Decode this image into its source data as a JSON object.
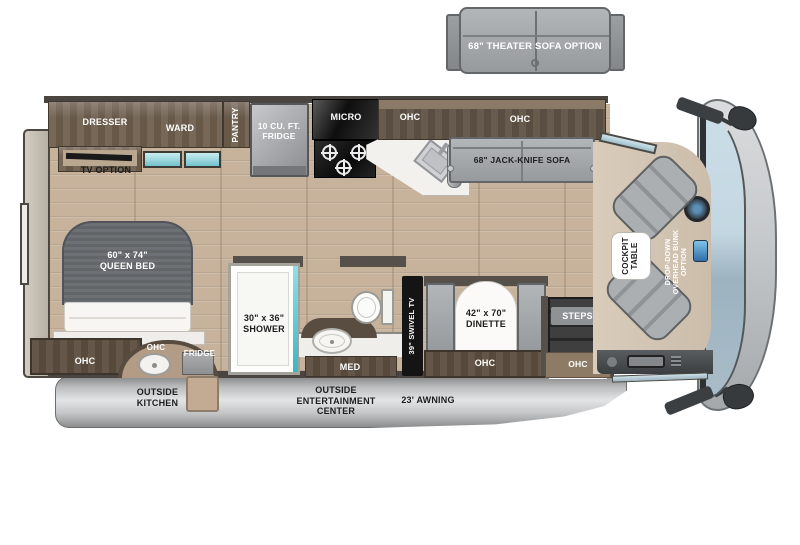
{
  "colors": {
    "wood_cabinet": "#6d5e4d",
    "wood_dark": "#5c4e3f",
    "floor_plank": "#c7b39c",
    "furniture_gray": "#9ea2a5",
    "window_teal": "#72c2cb",
    "windshield_blue": "#b9cdd9",
    "awning_gray": "#c9cacb",
    "cab_floor": "#d6c8b6"
  },
  "theater_sofa": {
    "label": "68\" THEATER SOFA OPTION"
  },
  "bedroom": {
    "dresser": "DRESSER",
    "ward": "WARD",
    "pantry": "PANTRY",
    "tv_option": "TV OPTION",
    "queen_bed": "60\" x 74\"\nQUEEN BED",
    "ohc": "OHC"
  },
  "kitchen": {
    "fridge": "10 CU. FT.\nFRIDGE",
    "micro": "MICRO",
    "ohc": "OHC"
  },
  "living": {
    "ohc": "OHC",
    "sofa": "68\" JACK-KNIFE SOFA"
  },
  "bathroom": {
    "shower": "30\" x 36\"\nSHOWER",
    "med": "MED",
    "tv": "39\" SWIVEL TV"
  },
  "dinette": {
    "table": "42\" x 70\"\nDINETTE",
    "ohc": "OHC"
  },
  "entry": {
    "steps": "STEPS",
    "ohc": "OHC"
  },
  "cockpit": {
    "table": "COCKPIT\nTABLE",
    "bunk": "DROP-DOWN\nOVERHEAD BUNK\nOPTION"
  },
  "exterior": {
    "outside_kitchen": "OUTSIDE\nKITCHEN",
    "fridge": "FRIDGE",
    "ohc": "OHC",
    "entertainment": "OUTSIDE\nENTERTAINMENT\nCENTER",
    "awning": "23' AWNING"
  }
}
